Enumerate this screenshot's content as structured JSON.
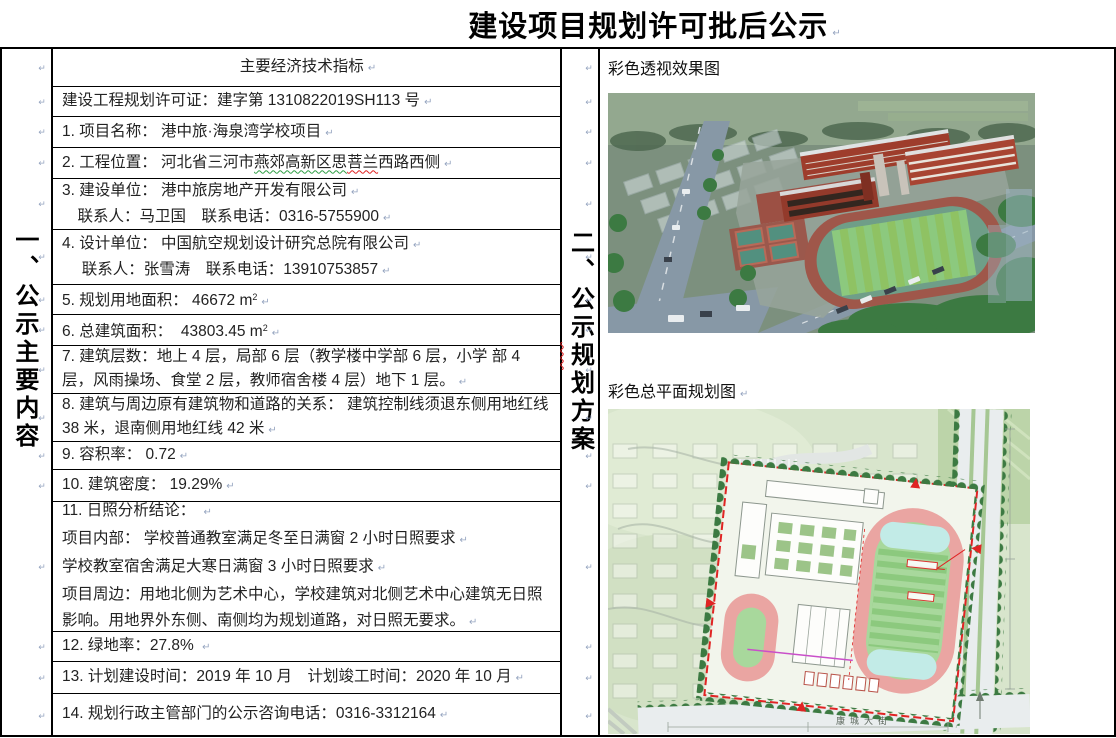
{
  "title": {
    "text": "建设项目规划许可批后公示"
  },
  "left_gutter": {
    "vertical_label_segments": [
      {
        "t": "一、公示主要内容"
      }
    ]
  },
  "right_gutter": {
    "vertical_label_segments": [
      {
        "t": "二、公示"
      },
      {
        "t": "规",
        "u": "red"
      },
      {
        "t": "划方案"
      }
    ]
  },
  "table": {
    "rows": [
      {
        "h": 38,
        "align": "center",
        "ps": [
          [
            {
              "t": "主要经济技术指标"
            }
          ]
        ]
      },
      {
        "h": 30,
        "ps": [
          [
            {
              "t": "建设工程规划许可证：建字第 1310822019SH113 号"
            }
          ]
        ]
      },
      {
        "h": 31,
        "ps": [
          [
            {
              "t": "1. 项目名称： 港中旅·海泉湾学校项目"
            }
          ]
        ]
      },
      {
        "h": 31,
        "ps": [
          [
            {
              "t": "2. 工程位置： 河北省三河市"
            },
            {
              "t": "燕郊高新区思",
              "u": "green"
            },
            {
              "t": "菩兰",
              "u": "red"
            },
            {
              "t": "西路西侧"
            }
          ]
        ]
      },
      {
        "h": 51,
        "ps": [
          [
            {
              "t": "3. 建设单位： 港中旅房地产开发有限公司"
            }
          ],
          [
            {
              "t": "　联系人：马卫国　联系电话：0316-5755900"
            }
          ]
        ]
      },
      {
        "h": 55,
        "ps": [
          [
            {
              "t": "4. 设计单位： 中国航空规划设计研究总院有限公司"
            }
          ],
          [
            {
              "t": "　 联系人：张雪涛　联系电话：13910753857"
            }
          ]
        ]
      },
      {
        "h": 30,
        "ps": [
          [
            {
              "t": "5. 规划用地面积： 46672 m"
            },
            {
              "t": "2",
              "sup": true
            }
          ]
        ]
      },
      {
        "h": 31,
        "ps": [
          [
            {
              "t": "6. 总建筑面积：  43803.45 m"
            },
            {
              "t": "2",
              "sup": true
            }
          ]
        ]
      },
      {
        "h": 48,
        "ps": [
          [
            {
              "t": "7. 建筑层数：地上 4 层，局部 6 层（教学楼中学部 6 层，小学 部 4 层，风雨操场、食堂 2 层，教师宿舍楼 4 层）地下 1 层。"
            }
          ]
        ]
      },
      {
        "h": 48,
        "ps": [
          [
            {
              "t": "8. 建筑与周边原有建筑物和道路的关系： 建筑控制线须退东侧用地红线 38 米，退南侧用地红线 42 米"
            }
          ]
        ]
      },
      {
        "h": 28,
        "ps": [
          [
            {
              "t": "9. 容积率： 0.72"
            }
          ]
        ]
      },
      {
        "h": 32,
        "ps": [
          [
            {
              "t": "10. 建筑密度： 19.29%"
            }
          ]
        ]
      },
      {
        "h": 130,
        "lh": 26,
        "ps": [
          [
            {
              "t": "11. 日照分析结论： "
            }
          ],
          [
            {
              "t": "项目内部： 学校普通教室满足冬至日满窗 2 小时日照要求"
            }
          ],
          [
            {
              "t": "学校教室宿舍满足大寒日满窗 3 小时日照要求"
            }
          ],
          [
            {
              "t": "项目周边：用地北侧为艺术中心，学校建筑对北侧艺术中心建筑无日照影响。用地界外东侧、南侧均为规划道路，对日照无要求。"
            }
          ]
        ]
      },
      {
        "h": 30,
        "ps": [
          [
            {
              "t": "12. 绿地率：27.8% "
            }
          ]
        ]
      },
      {
        "h": 32,
        "ps": [
          [
            {
              "t": "13. 计划建设时间：2019 年 10 月　计划竣工时间：2020 年 10 月"
            }
          ]
        ]
      },
      {
        "h": 44,
        "ps": [
          [
            {
              "t": "14. 规划行政主管部门的公示咨询电话：0316-3312164"
            }
          ]
        ]
      }
    ]
  },
  "right_panel": {
    "perspective_label": "彩色透视效果图",
    "plan_label": "彩色总平面规划图",
    "plan_street_label": "康城大街"
  },
  "palette": {
    "boundary_red": "#e02424",
    "brick_red": "#9e3d2c",
    "track_pink": "#eaa5a2",
    "field_green": "#8cc97e",
    "tree_green": "#3c7a42",
    "road_gray": "#8798a6",
    "pilcrow_blue": "#96a5c0",
    "squiggle_red": "#e02020",
    "squiggle_green": "#2f9e44"
  }
}
